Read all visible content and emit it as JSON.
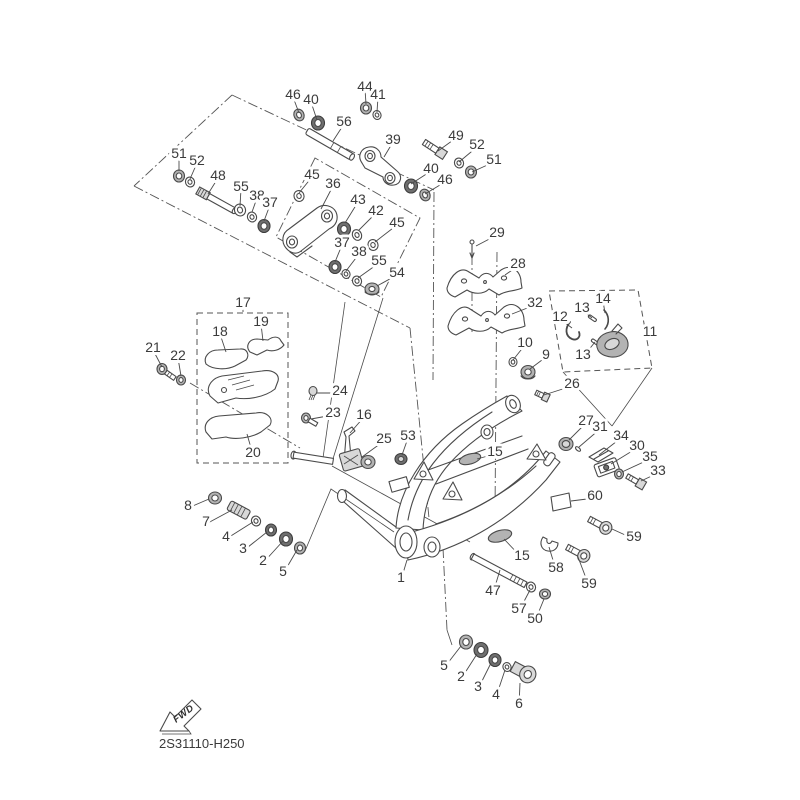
{
  "diagram": {
    "code": "2S31110-H250",
    "fwd_label": "FWD",
    "background": "#ffffff",
    "line_color": "#4a4a4a",
    "label_color": "#3b3b3b"
  },
  "callouts": [
    {
      "label": "46",
      "x": 293,
      "y": 95,
      "tx": 299,
      "ty": 113
    },
    {
      "label": "40",
      "x": 311,
      "y": 100,
      "tx": 317,
      "ty": 120
    },
    {
      "label": "44",
      "x": 365,
      "y": 87,
      "tx": 366,
      "ty": 104
    },
    {
      "label": "41",
      "x": 378,
      "y": 95,
      "tx": 377,
      "ty": 112
    },
    {
      "label": "56",
      "x": 344,
      "y": 122,
      "tx": 333,
      "ty": 141
    },
    {
      "label": "39",
      "x": 393,
      "y": 140,
      "tx": 384,
      "ty": 157
    },
    {
      "label": "49",
      "x": 456,
      "y": 136,
      "tx": 438,
      "ty": 151
    },
    {
      "label": "52",
      "x": 477,
      "y": 145,
      "tx": 459,
      "ty": 162
    },
    {
      "label": "51",
      "x": 494,
      "y": 160,
      "tx": 472,
      "ty": 172
    },
    {
      "label": "51",
      "x": 179,
      "y": 154,
      "tx": 179,
      "ty": 171
    },
    {
      "label": "52",
      "x": 197,
      "y": 161,
      "tx": 190,
      "ty": 179
    },
    {
      "label": "48",
      "x": 218,
      "y": 176,
      "tx": 208,
      "ty": 194
    },
    {
      "label": "55",
      "x": 241,
      "y": 187,
      "tx": 240,
      "ty": 206
    },
    {
      "label": "38",
      "x": 257,
      "y": 196,
      "tx": 252,
      "ty": 212
    },
    {
      "label": "37",
      "x": 270,
      "y": 203,
      "tx": 264,
      "ty": 221
    },
    {
      "label": "45",
      "x": 312,
      "y": 175,
      "tx": 299,
      "ty": 193
    },
    {
      "label": "36",
      "x": 333,
      "y": 184,
      "tx": 321,
      "ty": 209
    },
    {
      "label": "43",
      "x": 358,
      "y": 200,
      "tx": 345,
      "ty": 223
    },
    {
      "label": "42",
      "x": 376,
      "y": 211,
      "tx": 359,
      "ty": 230
    },
    {
      "label": "45",
      "x": 397,
      "y": 223,
      "tx": 375,
      "ty": 242
    },
    {
      "label": "37",
      "x": 342,
      "y": 243,
      "tx": 335,
      "ty": 262
    },
    {
      "label": "38",
      "x": 359,
      "y": 252,
      "tx": 346,
      "ty": 271
    },
    {
      "label": "55",
      "x": 379,
      "y": 261,
      "tx": 358,
      "ty": 278
    },
    {
      "label": "54",
      "x": 397,
      "y": 273,
      "tx": 377,
      "ty": 286
    },
    {
      "label": "40",
      "x": 431,
      "y": 169,
      "tx": 411,
      "ty": 184
    },
    {
      "label": "46",
      "x": 445,
      "y": 180,
      "tx": 425,
      "ty": 194
    },
    {
      "label": "29",
      "x": 497,
      "y": 233,
      "tx": 476,
      "ty": 246
    },
    {
      "label": "28",
      "x": 518,
      "y": 264,
      "tx": 505,
      "ty": 275
    },
    {
      "label": "32",
      "x": 535,
      "y": 303,
      "tx": 512,
      "ty": 314
    },
    {
      "label": "14",
      "x": 603,
      "y": 299,
      "tx": 605,
      "ty": 313
    },
    {
      "label": "13",
      "x": 582,
      "y": 308,
      "tx": 592,
      "ty": 318
    },
    {
      "label": "12",
      "x": 560,
      "y": 317,
      "tx": 572,
      "ty": 328
    },
    {
      "label": "13",
      "x": 583,
      "y": 355,
      "tx": 595,
      "ty": 342
    },
    {
      "label": "11",
      "x": 650,
      "y": 332,
      "tx": 641,
      "ty": 336
    },
    {
      "label": "10",
      "x": 525,
      "y": 343,
      "tx": 513,
      "ty": 360
    },
    {
      "label": "9",
      "x": 546,
      "y": 355,
      "tx": 530,
      "ty": 369
    },
    {
      "label": "26",
      "x": 572,
      "y": 384,
      "tx": 544,
      "ty": 395
    },
    {
      "label": "27",
      "x": 586,
      "y": 421,
      "tx": 569,
      "ty": 440
    },
    {
      "label": "31",
      "x": 600,
      "y": 427,
      "tx": 579,
      "ty": 447
    },
    {
      "label": "34",
      "x": 621,
      "y": 436,
      "tx": 599,
      "ty": 455
    },
    {
      "label": "30",
      "x": 637,
      "y": 446,
      "tx": 611,
      "ty": 464
    },
    {
      "label": "35",
      "x": 650,
      "y": 457,
      "tx": 622,
      "ty": 472
    },
    {
      "label": "33",
      "x": 658,
      "y": 471,
      "tx": 641,
      "ty": 481
    },
    {
      "label": "60",
      "x": 595,
      "y": 496,
      "tx": 571,
      "ty": 501
    },
    {
      "label": "59",
      "x": 634,
      "y": 537,
      "tx": 612,
      "ty": 529
    },
    {
      "label": "58",
      "x": 556,
      "y": 568,
      "tx": 549,
      "ty": 547
    },
    {
      "label": "59",
      "x": 589,
      "y": 584,
      "tx": 578,
      "ty": 557
    },
    {
      "label": "17",
      "x": 243,
      "y": 303,
      "tx": 243,
      "ty": 312
    },
    {
      "label": "18",
      "x": 220,
      "y": 332,
      "tx": 226,
      "ty": 352
    },
    {
      "label": "19",
      "x": 261,
      "y": 322,
      "tx": 263,
      "ty": 341
    },
    {
      "label": "21",
      "x": 153,
      "y": 348,
      "tx": 162,
      "ty": 367
    },
    {
      "label": "22",
      "x": 178,
      "y": 356,
      "tx": 181,
      "ty": 376
    },
    {
      "label": "24",
      "x": 340,
      "y": 391,
      "tx": 317,
      "ty": 393
    },
    {
      "label": "23",
      "x": 333,
      "y": 413,
      "tx": 311,
      "ty": 419
    },
    {
      "label": "16",
      "x": 364,
      "y": 415,
      "tx": 350,
      "ty": 433
    },
    {
      "label": "25",
      "x": 384,
      "y": 439,
      "tx": 362,
      "ty": 457
    },
    {
      "label": "53",
      "x": 408,
      "y": 436,
      "tx": 402,
      "ty": 455
    },
    {
      "label": "20",
      "x": 253,
      "y": 453,
      "tx": 247,
      "ty": 434
    },
    {
      "label": "15",
      "x": 495,
      "y": 452,
      "tx": 477,
      "ty": 459
    },
    {
      "label": "15",
      "x": 522,
      "y": 556,
      "tx": 504,
      "ty": 539
    },
    {
      "label": "8",
      "x": 188,
      "y": 506,
      "tx": 209,
      "ty": 499
    },
    {
      "label": "7",
      "x": 206,
      "y": 522,
      "tx": 232,
      "ty": 510
    },
    {
      "label": "4",
      "x": 226,
      "y": 537,
      "tx": 253,
      "ty": 522
    },
    {
      "label": "3",
      "x": 243,
      "y": 549,
      "tx": 267,
      "ty": 532
    },
    {
      "label": "2",
      "x": 263,
      "y": 561,
      "tx": 283,
      "ty": 541
    },
    {
      "label": "5",
      "x": 283,
      "y": 572,
      "tx": 297,
      "ty": 550
    },
    {
      "label": "1",
      "x": 401,
      "y": 578,
      "tx": 407,
      "ty": 560
    },
    {
      "label": "47",
      "x": 493,
      "y": 591,
      "tx": 500,
      "ty": 570
    },
    {
      "label": "57",
      "x": 519,
      "y": 609,
      "tx": 530,
      "ty": 590
    },
    {
      "label": "50",
      "x": 535,
      "y": 619,
      "tx": 544,
      "ty": 599
    },
    {
      "label": "5",
      "x": 444,
      "y": 666,
      "tx": 461,
      "ty": 646
    },
    {
      "label": "2",
      "x": 461,
      "y": 677,
      "tx": 477,
      "ty": 654
    },
    {
      "label": "3",
      "x": 478,
      "y": 687,
      "tx": 491,
      "ty": 663
    },
    {
      "label": "4",
      "x": 496,
      "y": 695,
      "tx": 505,
      "ty": 670
    },
    {
      "label": "6",
      "x": 519,
      "y": 704,
      "tx": 520,
      "ty": 683
    }
  ]
}
